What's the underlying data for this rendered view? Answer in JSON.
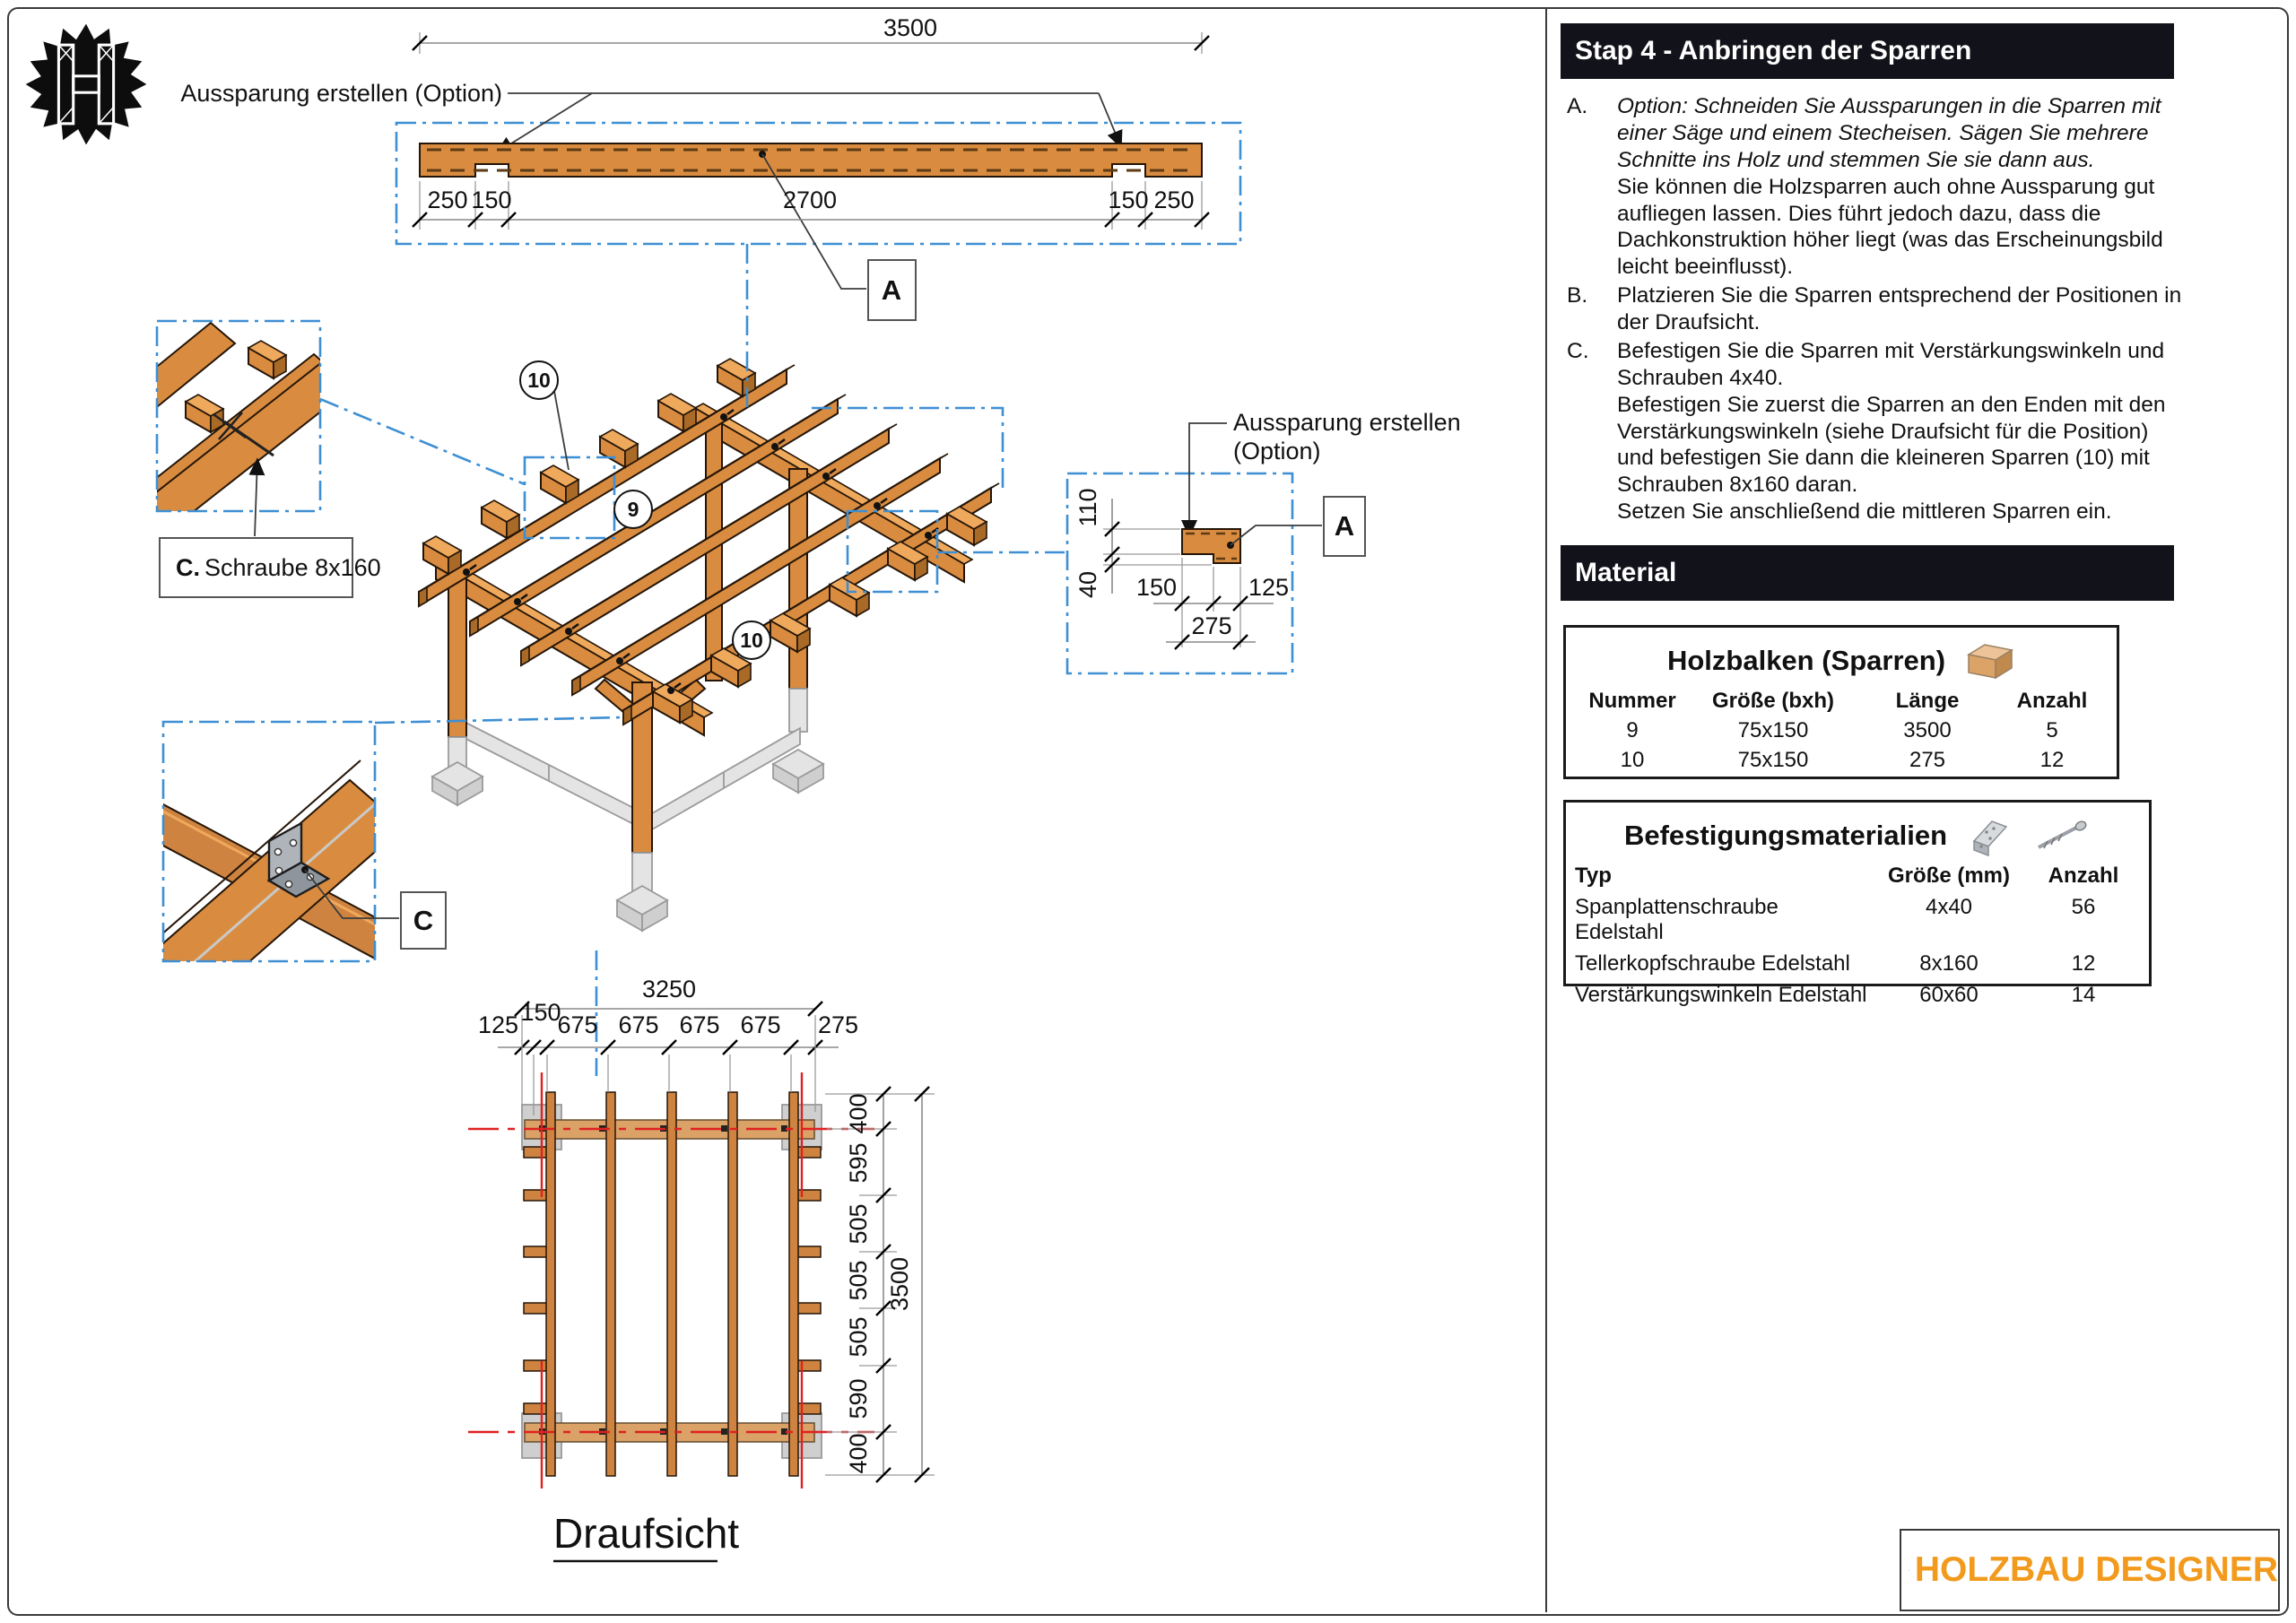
{
  "panel": {
    "title": "Stap 4 - Anbringen der Sparren",
    "steps": [
      {
        "label": "A.",
        "parts": [
          "Option: Schneiden Sie Aussparungen in die Sparren mit einer Säge und einem Stecheisen. Sägen Sie mehrere Schnitte ins Holz und stemmen Sie sie dann aus.",
          "Sie können die Holzsparren auch ohne Aussparung gut aufliegen lassen. Dies führt jedoch dazu, dass die Dachkonstruktion höher liegt (was das Erscheinungsbild leicht beeinflusst)."
        ]
      },
      {
        "label": "B.",
        "parts": [
          "Platzieren Sie die Sparren entsprechend der Positionen in der Draufsicht."
        ]
      },
      {
        "label": "C.",
        "parts": [
          "Befestigen Sie die Sparren mit Verstärkungswinkeln und Schrauben 4x40.",
          "Befestigen Sie zuerst die Sparren an den Enden mit den Verstärkungswinkeln (siehe Draufsicht für die Position) und befestigen Sie dann die kleineren Sparren (10) mit Schrauben 8x160 daran.",
          "Setzen Sie anschließend die mittleren Sparren ein."
        ]
      }
    ],
    "material_title": "Material",
    "holzbalken": {
      "title": "Holzbalken (Sparren)",
      "headers": [
        "Nummer",
        "Größe (bxh)",
        "Länge",
        "Anzahl"
      ],
      "rows": [
        [
          "9",
          "75x150",
          "3500",
          "5"
        ],
        [
          "10",
          "75x150",
          "275",
          "12"
        ]
      ]
    },
    "befestigung": {
      "title": "Befestigungsmaterialien",
      "headers": [
        "Typ",
        "Größe (mm)",
        "Anzahl"
      ],
      "rows": [
        [
          "Spanplattenschraube Edelstahl",
          "4x40",
          "56"
        ],
        [
          "Tellerkopfschraube Edelstahl",
          "8x160",
          "12"
        ],
        [
          "Verstärkungswinkeln Edelstahl",
          "60x60",
          "14"
        ]
      ]
    }
  },
  "drawings": {
    "beam": {
      "total": "3500",
      "d1": "250",
      "d2": "150",
      "d3": "2700",
      "d4": "150",
      "d5": "250",
      "note": "Aussparung erstellen (Option)",
      "marker": "A"
    },
    "detail_screw": {
      "label_bold": "C.",
      "label_rest": "Schraube 8x160"
    },
    "detail_bracket": {
      "marker": "C"
    },
    "iso": {
      "callout_top": "10",
      "callout_mid": "9",
      "callout_bottom": "10"
    },
    "section": {
      "note1": "Aussparung erstellen",
      "note2": "(Option)",
      "v1": "110",
      "v2": "40",
      "h1": "150",
      "h2": "125",
      "total": "275",
      "marker": "A"
    },
    "plan": {
      "title": "Draufsicht",
      "total_w": "3250",
      "w": [
        "125",
        "150",
        "675",
        "675",
        "675",
        "675",
        "275"
      ],
      "total_h": "3500",
      "h": [
        "400",
        "595",
        "505",
        "505",
        "505",
        "590",
        "400"
      ]
    }
  },
  "brand": {
    "name": "HOLZBAU DESIGNER"
  },
  "colors": {
    "accent_orange": "#F29A1D",
    "wood": "#D98C3F",
    "section_blue": "#3E8FD3",
    "centerline_red": "#E02121",
    "bar_dark": "#12121B"
  }
}
